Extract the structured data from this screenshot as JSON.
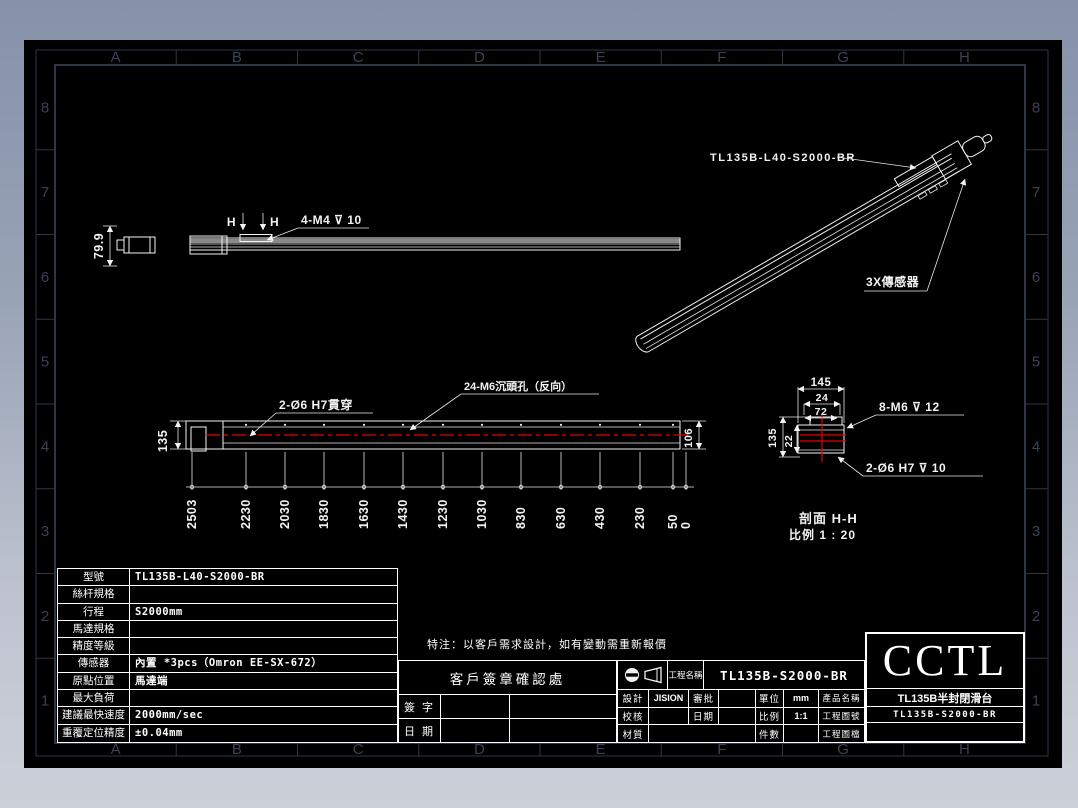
{
  "colors": {
    "background_top": "#8592a9",
    "background_bottom": "#ccd0d9",
    "canvas": "#000000",
    "frame": "#3a4254",
    "line": "#f2f2f2",
    "accent_red": "#e60000",
    "gray_fill": "#8a8a8a"
  },
  "grid": {
    "columns": [
      "A",
      "B",
      "C",
      "D",
      "E",
      "F",
      "G",
      "H"
    ],
    "rows": [
      "8",
      "7",
      "6",
      "5",
      "4",
      "3",
      "2",
      "1"
    ]
  },
  "views": {
    "side_view": {
      "height_dim": "79.9",
      "section_mark_left": "H",
      "section_mark_right": "H",
      "thread_callout": "4-M4 ⊽ 10"
    },
    "iso_view": {
      "model_callout": "TL135B-L40-S2000-BR",
      "sensor_callout": "3X傳感器"
    },
    "front_view": {
      "hole_callout": "2-Ø6 H7貫穿",
      "counterbore_callout": "24-M6沉頭孔（反向）",
      "height_dim": "135",
      "right_height_dim": "106",
      "stations": [
        "2503",
        "2230",
        "2030",
        "1830",
        "1630",
        "1430",
        "1230",
        "1030",
        "830",
        "630",
        "430",
        "230",
        "50",
        "0"
      ]
    },
    "section_view": {
      "width_dim": "145",
      "pitch_dim": "24",
      "mid_dim": "72",
      "height_dim": "135",
      "offset_dim": "22",
      "thread_callout": "8-M6 ⊽ 12",
      "hole_callout": "2-Ø6 H7 ⊽ 10",
      "caption_line1": "剖面 H-H",
      "caption_line2": "比例 1 : 20"
    }
  },
  "spec_table": {
    "rows": [
      {
        "label": "型號",
        "value": "TL135B-L40-S2000-BR"
      },
      {
        "label": "絲杆規格",
        "value": ""
      },
      {
        "label": "行程",
        "value": "S2000mm"
      },
      {
        "label": "馬達規格",
        "value": ""
      },
      {
        "label": "精度等級",
        "value": ""
      },
      {
        "label": "傳感器",
        "value": "內置 *3pcs（Omron EE-SX-672）"
      },
      {
        "label": "原點位置",
        "value": "馬達端"
      },
      {
        "label": "最大負荷",
        "value": ""
      },
      {
        "label": "建議最快速度",
        "value": "2000mm/sec"
      },
      {
        "label": "重覆定位精度",
        "value": "±0.04mm"
      }
    ]
  },
  "note": "特注：以客戶需求設計，如有變動需重新報價",
  "signature_box": {
    "title": "客戶簽章確認處",
    "sign_label": "簽 字",
    "date_label": "日 期"
  },
  "title_block": {
    "project_name_label": "工程名稱",
    "project_name_value": "TL135B-S2000-BR",
    "designer_label": "設計",
    "designer_value": "JISION",
    "approver_label": "審批",
    "approver_value": "",
    "checker_label": "校核",
    "checker_value": "",
    "date_label": "日期",
    "date_value": "",
    "material_label": "材質",
    "material_value": "",
    "unit_label": "單位",
    "unit_value": "mm",
    "scale_label": "比例",
    "scale_value": "1:1",
    "qty_label": "件數",
    "qty_value": "",
    "product_name_label": "產品名稱",
    "product_name_value": "TL135B半封閉滑台",
    "drawing_no_label": "工程圖號",
    "drawing_no_value": "TL135B-S2000-BR",
    "file_label": "工程圖檔",
    "file_value": "",
    "logo": "CCTL"
  }
}
